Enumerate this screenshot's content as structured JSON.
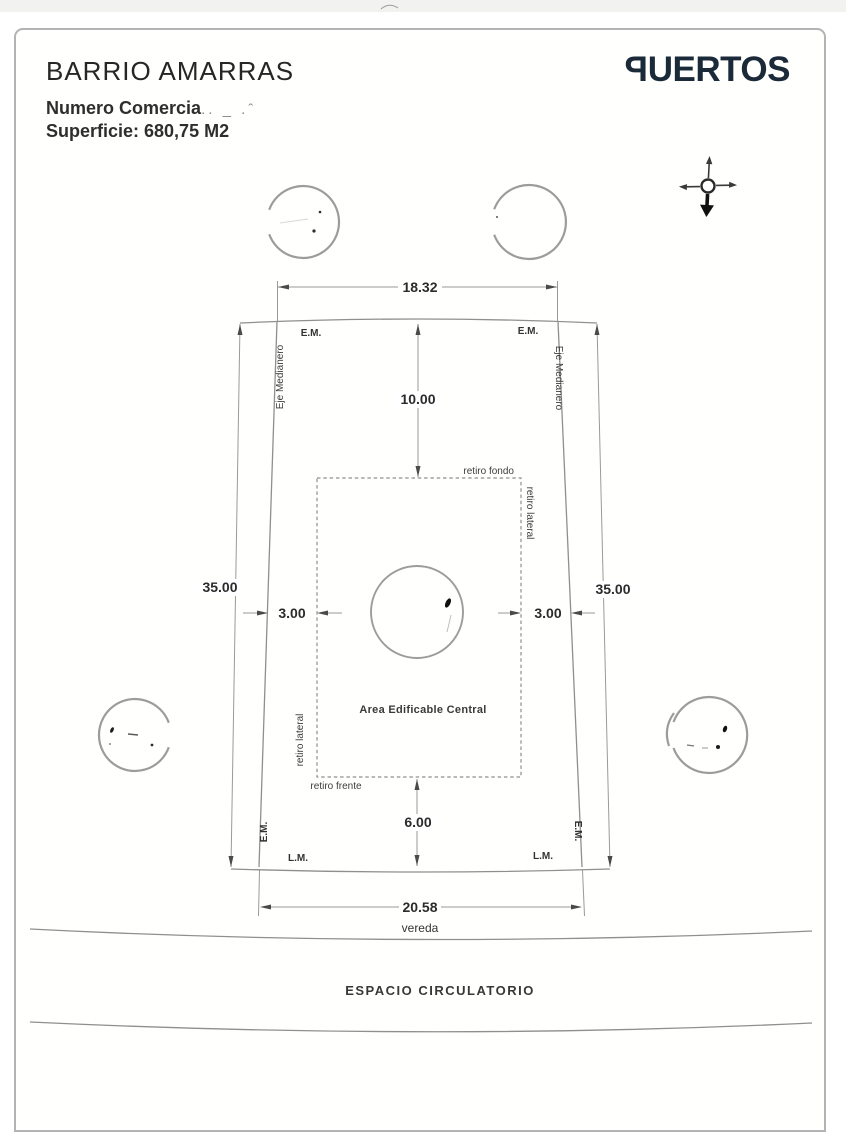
{
  "document": {
    "header": {
      "title": "BARRIO AMARRAS",
      "lot_line_label": "Numero Comercia",
      "lot_line_smudge": ".. _ .ˆ",
      "surface_line": "Superficie: 680,75 M2"
    },
    "brand": {
      "reversed_letter": "P",
      "wordmark_rest": "UERTOS",
      "color": "#1b2a38"
    }
  },
  "plan": {
    "dimensions": {
      "top_width": "18.32",
      "left_depth": "35.00",
      "right_depth": "35.00",
      "rear_setback": "10.00",
      "left_setback": "3.00",
      "right_setback": "3.00",
      "front_setback": "6.00",
      "bottom_width": "20.58"
    },
    "labels": {
      "em": "E.M.",
      "lm": "L.M.",
      "eje_medianero": "Eje Medianero",
      "retiro_fondo": "retiro fondo",
      "retiro_lateral": "retiro lateral",
      "retiro_frente": "retiro frente",
      "area_edificable": "Area Edificable Central",
      "vereda": "vereda",
      "espacio_circulatorio": "ESPACIO CIRCULATORIO"
    }
  }
}
